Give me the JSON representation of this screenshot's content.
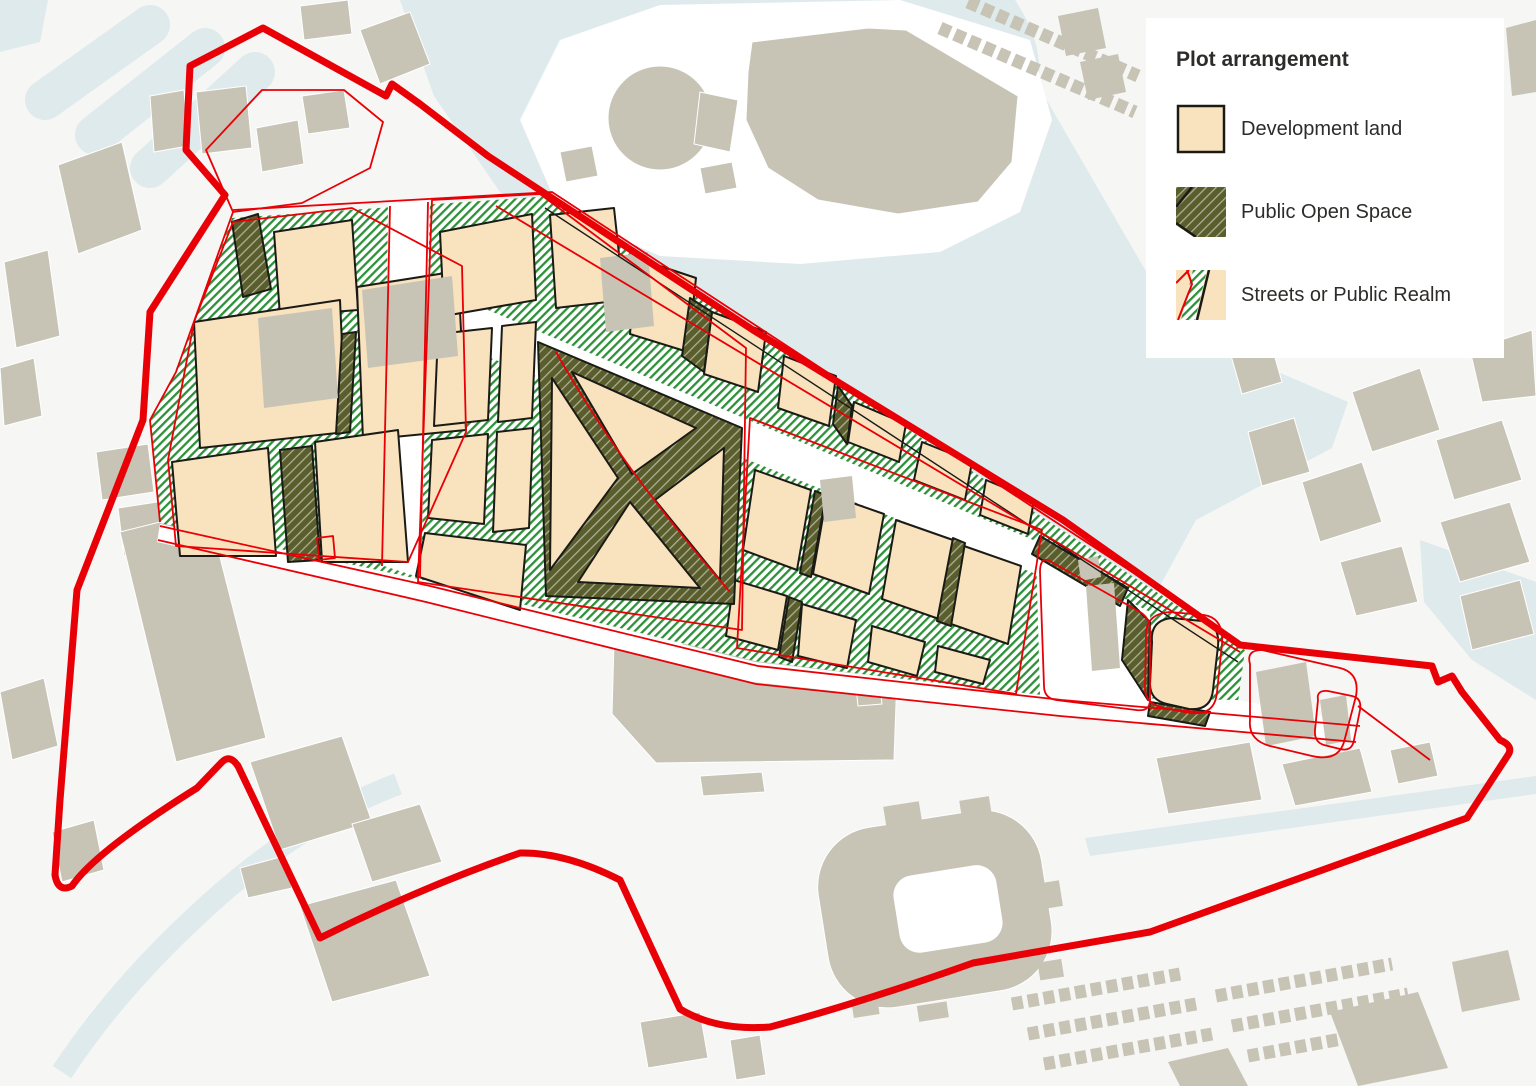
{
  "legend": {
    "title": "Plot arrangement",
    "items": [
      {
        "id": "development-land",
        "label": "Development land"
      },
      {
        "id": "public-open-space",
        "label": "Public Open Space"
      },
      {
        "id": "streets-public-realm",
        "label": "Streets or Public Realm"
      }
    ]
  },
  "colors": {
    "red": "#E80006",
    "dev": "#F9E2BE",
    "pos": "#5A5E2C",
    "street": "#2E9139",
    "bldg": "#C7C4B6",
    "water": "#DFEAED",
    "bg": "#F6F6F4",
    "ink": "#1B1B16",
    "text": "#2D2C2A",
    "white": "#FFFFFF"
  }
}
